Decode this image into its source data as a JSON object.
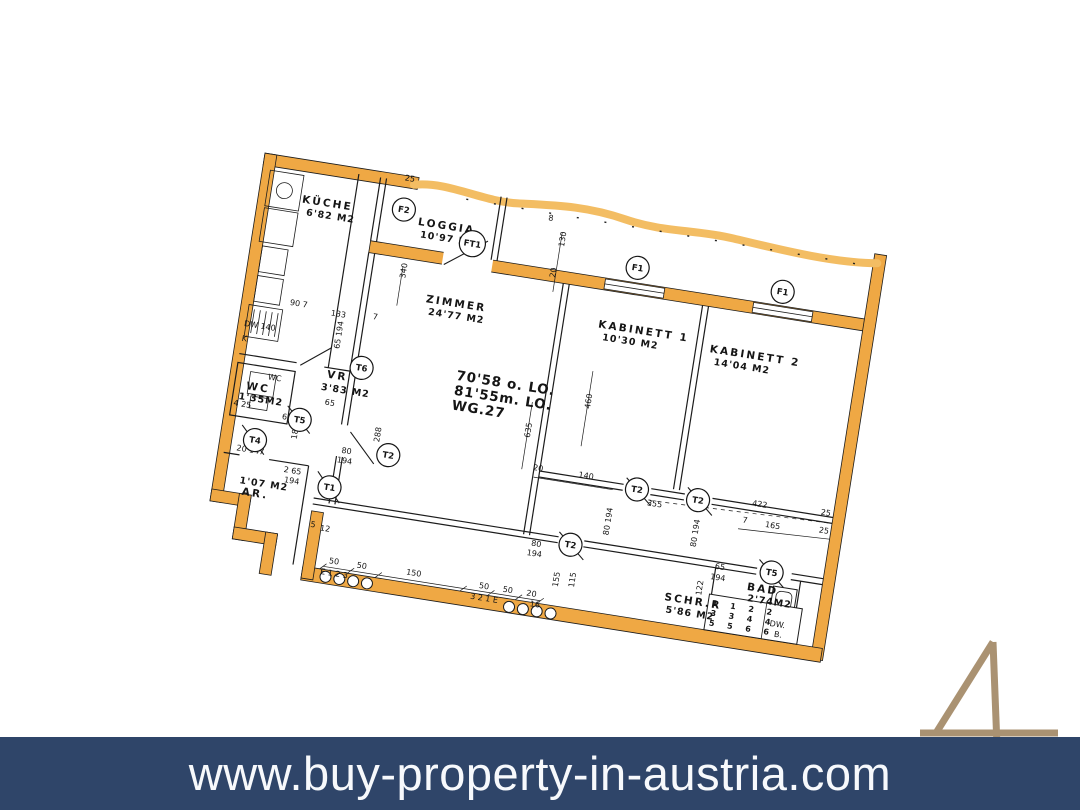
{
  "banner": {
    "url": "www.buy-property-in-austria.com",
    "bg_color": "#2f4569",
    "text_color": "#ffffff"
  },
  "watermark": {
    "glyph": "4",
    "color": "#aa9272"
  },
  "plan": {
    "colors": {
      "wall": "#efa844",
      "wall_light": "#f3bd63",
      "ink": "#1c1c1c"
    },
    "title_block": {
      "line1": "70'58 o. LO.",
      "line2": "81'55m. LO.",
      "line3": "WG.27"
    },
    "rooms": [
      {
        "name": "KÜCHE",
        "area": "6'82 M2",
        "x": 38,
        "y": 37,
        "ax": 44,
        "ay": 49
      },
      {
        "name": "LOGGIA",
        "area": "10'97 M2",
        "x": 156,
        "y": 41,
        "ax": 160,
        "ay": 53
      },
      {
        "name": "ZIMMER",
        "area": "24'77 M2",
        "x": 176,
        "y": 116,
        "ax": 180,
        "ay": 128
      },
      {
        "name": "KABINETT 1",
        "area": "10'30 M2",
        "x": 350,
        "y": 114,
        "ax": 356,
        "ay": 126
      },
      {
        "name": "KABINETT 2",
        "area": "14'04 M2",
        "x": 464,
        "y": 121,
        "ax": 470,
        "ay": 133
      },
      {
        "name": "WC",
        "area": "1'35M2",
        "x": 12,
        "y": 230,
        "ax": 6,
        "ay": 241
      },
      {
        "name": "VR",
        "area": "3'83 M2",
        "x": 90,
        "y": 206,
        "ax": 86,
        "ay": 219
      },
      {
        "name": "AR.",
        "area": "1'07 M2",
        "x": 24,
        "y": 335,
        "ax": 20,
        "ay": 324
      },
      {
        "name": "SCHR.R",
        "area": "5'86 M2",
        "x": 458,
        "y": 373,
        "ax": 461,
        "ay": 385
      },
      {
        "name": "BAD",
        "area": "2'74M2",
        "x": 538,
        "y": 350,
        "ax": 540,
        "ay": 361
      }
    ],
    "markers": [
      {
        "l": "F2",
        "x": 140,
        "y": 28
      },
      {
        "l": "FT1",
        "x": 213,
        "y": 51
      },
      {
        "l": "F1",
        "x": 380,
        "y": 49
      },
      {
        "l": "F1",
        "x": 527,
        "y": 50
      },
      {
        "l": "T6",
        "x": 123,
        "y": 191
      },
      {
        "l": "T5",
        "x": 70,
        "y": 252
      },
      {
        "l": "T4",
        "x": 29,
        "y": 279
      },
      {
        "l": "T1",
        "x": 110,
        "y": 314
      },
      {
        "l": "T2",
        "x": 163,
        "y": 273
      },
      {
        "l": "T2",
        "x": 357,
        "y": 333
      },
      {
        "l": "T2",
        "x": 414,
        "y": 268
      },
      {
        "l": "T2",
        "x": 476,
        "y": 269
      },
      {
        "l": "T5",
        "x": 560,
        "y": 329
      }
    ],
    "dimensions": [
      {
        "t": "25",
        "x": 136,
        "y": -1
      },
      {
        "t": "8",
        "x": 284,
        "y": 16
      },
      {
        "t": "130",
        "x": 304,
        "y": 40,
        "r": 1
      },
      {
        "t": "20",
        "x": 300,
        "y": 72,
        "r": 1
      },
      {
        "t": "340",
        "x": 152,
        "y": 96,
        "r": 1
      },
      {
        "t": "90  7",
        "x": 42,
        "y": 140
      },
      {
        "t": "133",
        "x": 84,
        "y": 144
      },
      {
        "t": "7",
        "x": 126,
        "y": 141
      },
      {
        "t": "DW 140",
        "x": 0,
        "y": 168
      },
      {
        "t": "K",
        "x": 0,
        "y": 183
      },
      {
        "t": "65 194",
        "x": 98,
        "y": 176,
        "r": 1
      },
      {
        "t": "WC",
        "x": 32,
        "y": 217
      },
      {
        "t": "635",
        "x": 300,
        "y": 234,
        "r": 1
      },
      {
        "t": "460",
        "x": 355,
        "y": 196,
        "r": 1
      },
      {
        "t": "65",
        "x": 92,
        "y": 233
      },
      {
        "t": "61 194",
        "x": 52,
        "y": 254
      },
      {
        "t": "4 25",
        "x": 2,
        "y": 248
      },
      {
        "t": "288",
        "x": 152,
        "y": 262,
        "r": 1
      },
      {
        "t": "181",
        "x": 70,
        "y": 272,
        "r": 1
      },
      {
        "t": "20  147",
        "x": 12,
        "y": 292
      },
      {
        "t": "2 65",
        "x": 62,
        "y": 306
      },
      {
        "t": "194",
        "x": 64,
        "y": 316
      },
      {
        "t": "80",
        "x": 116,
        "y": 278
      },
      {
        "t": "194",
        "x": 113,
        "y": 288
      },
      {
        "t": "80",
        "x": 318,
        "y": 340
      },
      {
        "t": "194",
        "x": 315,
        "y": 350
      },
      {
        "t": "80 194",
        "x": 393,
        "y": 318,
        "r": 1
      },
      {
        "t": "80 194",
        "x": 481,
        "y": 316,
        "r": 1
      },
      {
        "t": "20",
        "x": 308,
        "y": 265
      },
      {
        "t": "140",
        "x": 354,
        "y": 265
      },
      {
        "t": "355",
        "x": 426,
        "y": 282
      },
      {
        "t": "422",
        "x": 530,
        "y": 266
      },
      {
        "t": "7",
        "x": 523,
        "y": 284
      },
      {
        "t": "165",
        "x": 546,
        "y": 285
      },
      {
        "t": "25",
        "x": 599,
        "y": 264
      },
      {
        "t": "25",
        "x": 600,
        "y": 282
      },
      {
        "t": "65",
        "x": 503,
        "y": 334
      },
      {
        "t": "194",
        "x": 500,
        "y": 345
      },
      {
        "t": "122",
        "x": 494,
        "y": 363,
        "r": 1
      },
      {
        "t": "155",
        "x": 351,
        "y": 377,
        "r": 1
      },
      {
        "t": "115",
        "x": 367,
        "y": 375,
        "r": 1
      },
      {
        "t": "50",
        "x": 121,
        "y": 389
      },
      {
        "t": "50",
        "x": 149,
        "y": 389
      },
      {
        "t": "150",
        "x": 199,
        "y": 388
      },
      {
        "t": "50",
        "x": 273,
        "y": 390
      },
      {
        "t": "50",
        "x": 297,
        "y": 390
      },
      {
        "t": "20",
        "x": 321,
        "y": 390
      },
      {
        "t": "16",
        "x": 326,
        "y": 400
      },
      {
        "t": "5",
        "x": 97,
        "y": 356
      },
      {
        "t": "12",
        "x": 107,
        "y": 358
      },
      {
        "t": "E 1 2 3",
        "x": 114,
        "y": 401
      },
      {
        "t": "3 2 1 E",
        "x": 266,
        "y": 402
      }
    ],
    "bad_grid": {
      "rows": [
        "1 1 2 2",
        "3 3 4 4",
        "5 5 6 6"
      ],
      "col_label_top": "DW.",
      "col_label_bottom": "B."
    }
  }
}
